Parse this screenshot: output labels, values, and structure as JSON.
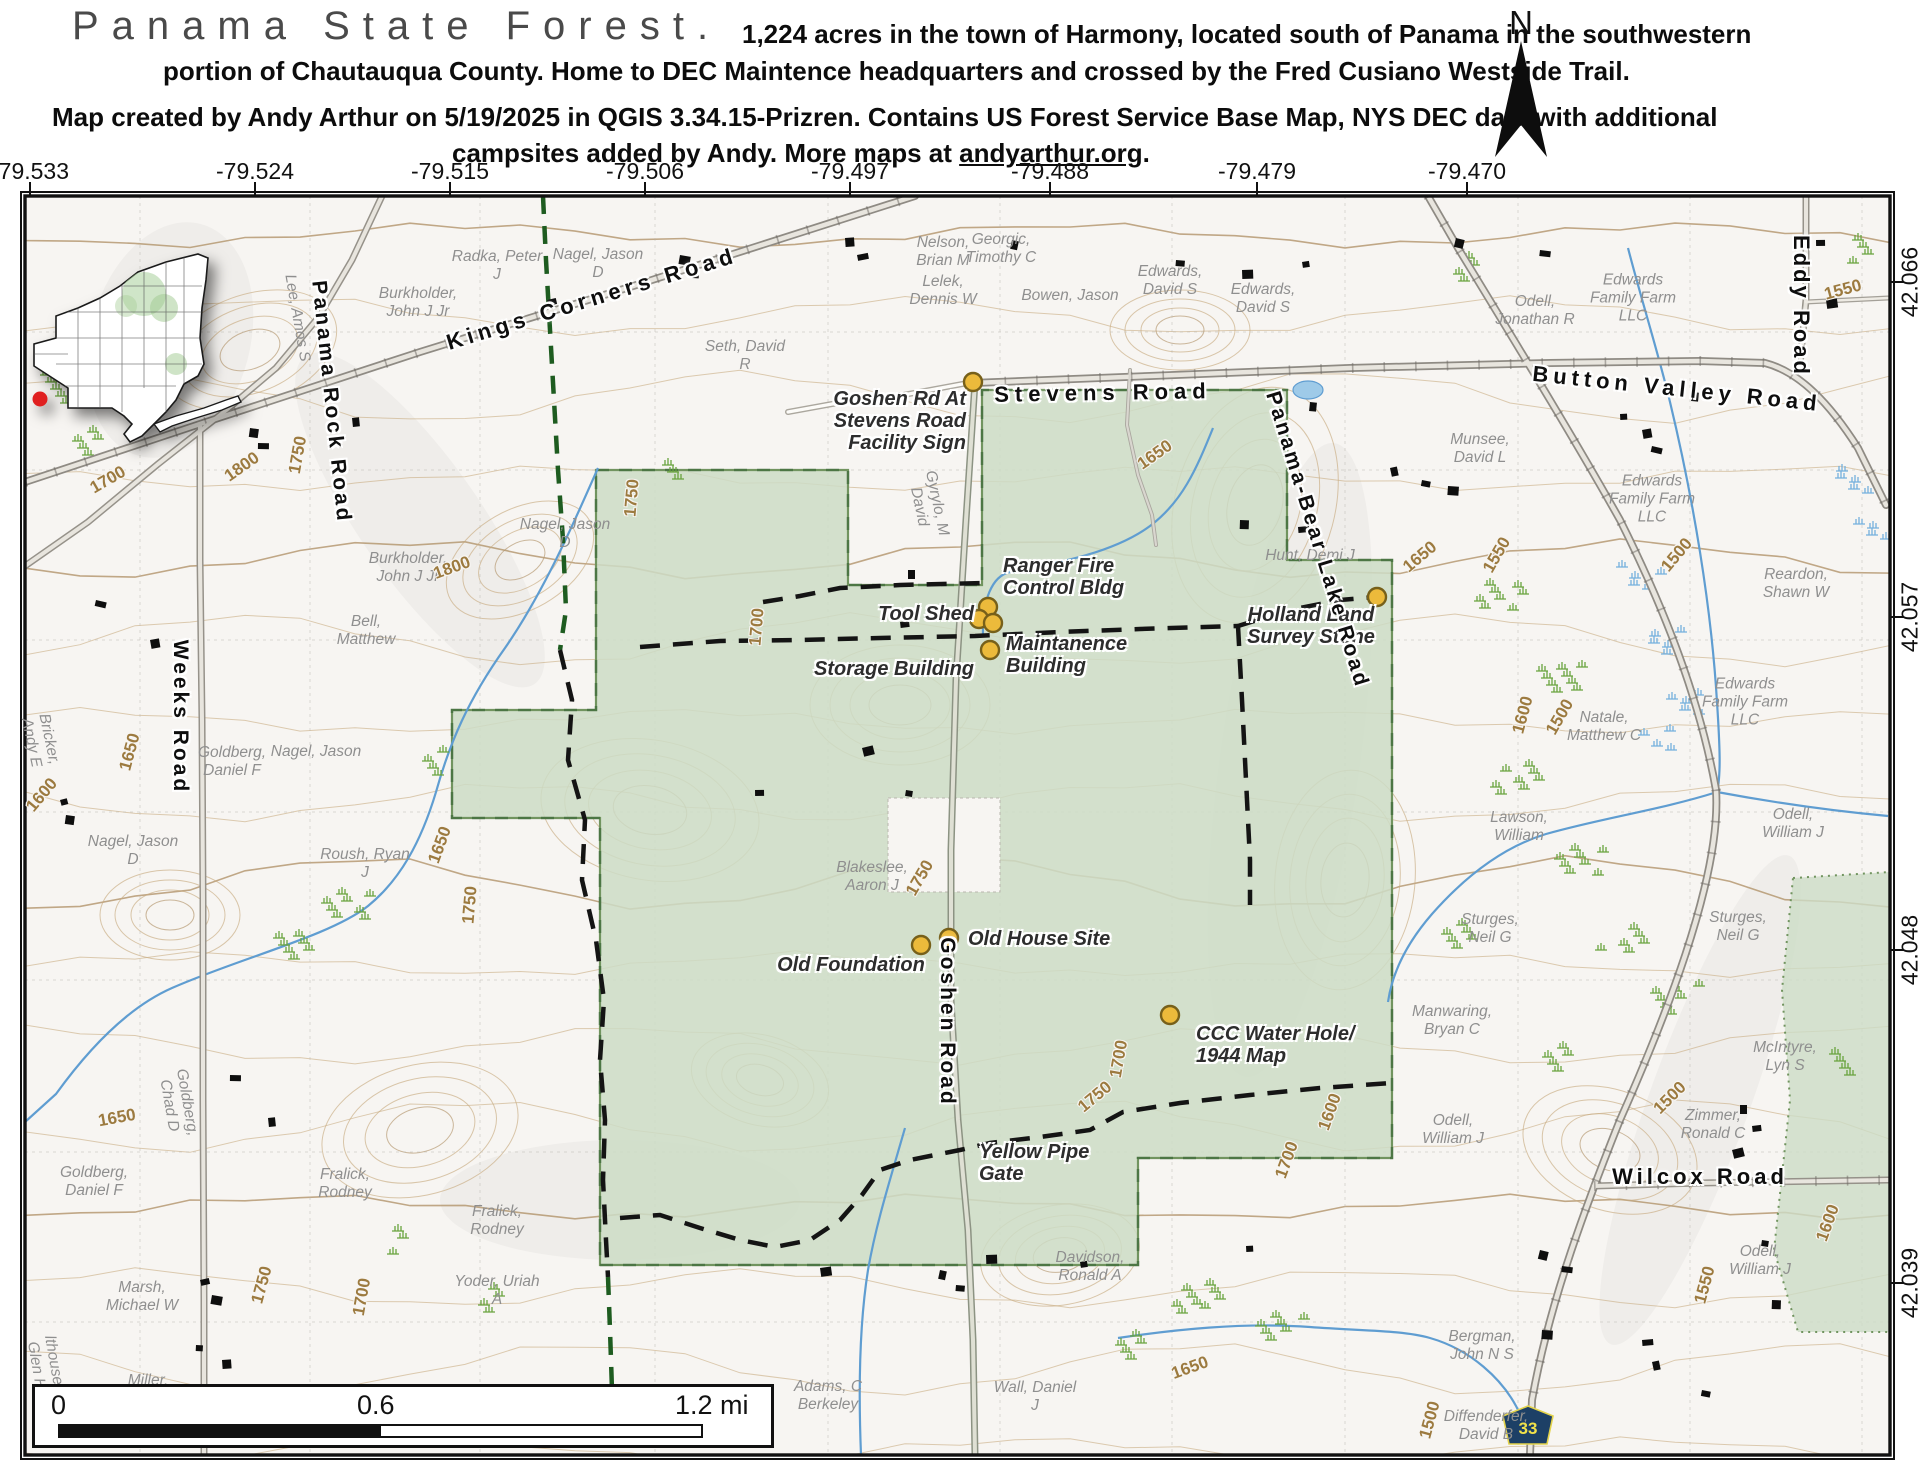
{
  "header": {
    "title": "Panama State Forest.",
    "subtitle_line1": "1,224 acres in the town of Harmony, located south of Panama in the southwestern",
    "subtitle_line2": "portion of Chautauqua County. Home to DEC Maintence headquarters and crossed by the Fred Cusiano Westside Trail.",
    "credit_line1": "Map created by Andy Arthur on 5/19/2025 in QGIS 3.34.15-Prizren. Contains US Forest Service Base Map, NYS DEC data with additional",
    "credit_line2_prefix": "campsites added by Andy. More maps at ",
    "credit_link": "andyarthur.org",
    "credit_line2_suffix": ".",
    "north_label": "N"
  },
  "axes": {
    "longitude": [
      {
        "label": "-79.533",
        "x": 30
      },
      {
        "label": "-79.524",
        "x": 255
      },
      {
        "label": "-79.515",
        "x": 450
      },
      {
        "label": "-79.506",
        "x": 645
      },
      {
        "label": "-79.497",
        "x": 850
      },
      {
        "label": "-79.488",
        "x": 1050
      },
      {
        "label": "-79.479",
        "x": 1257
      },
      {
        "label": "-79.470",
        "x": 1467
      }
    ],
    "latitude": [
      {
        "label": "42.066",
        "y": 282
      },
      {
        "label": "42.057",
        "y": 617
      },
      {
        "label": "42.048",
        "y": 950
      },
      {
        "label": "42.039",
        "y": 1283
      }
    ]
  },
  "scale_bar": {
    "start": "0",
    "middle": "0.6",
    "end": "1.2 mi"
  },
  "route_shield": {
    "number": "33"
  },
  "road_labels": [
    {
      "t": "Kings Corners Road",
      "x": 592,
      "y": 299,
      "r": -17,
      "ls": 5,
      "s": 22
    },
    {
      "t": "Stevens Road",
      "x": 1103,
      "y": 393,
      "r": -1,
      "ls": 6,
      "s": 22
    },
    {
      "t": "Button Valley Road",
      "x": 1677,
      "y": 389,
      "r": 6,
      "ls": 5,
      "s": 22
    },
    {
      "t": "Eddy Road",
      "x": 1801,
      "y": 306,
      "r": 90,
      "ls": 3,
      "s": 22
    },
    {
      "t": "Panama Rock Road",
      "x": 331,
      "y": 402,
      "r": 84,
      "ls": 3,
      "s": 21
    },
    {
      "t": "Weeks Road",
      "x": 180,
      "y": 717,
      "r": 90,
      "ls": 3,
      "s": 21
    },
    {
      "t": "Goshen Road",
      "x": 947,
      "y": 1022,
      "r": 90,
      "ls": 3,
      "s": 21
    },
    {
      "t": "Panama-Bear Lake Road",
      "x": 1317,
      "y": 540,
      "r": 73,
      "ls": 3,
      "s": 21
    },
    {
      "t": "Wilcox Road",
      "x": 1700,
      "y": 1177,
      "r": 0,
      "ls": 4,
      "s": 22
    }
  ],
  "poi_labels": [
    {
      "lines": "Goshen Rd At\nStevens Road\nFacility Sign",
      "x": 966,
      "y": 421,
      "align": "right"
    },
    {
      "lines": "Ranger Fire\nControl Bldg",
      "x": 1003,
      "y": 577,
      "align": "left"
    },
    {
      "lines": "Tool Shed",
      "x": 974,
      "y": 614,
      "align": "right"
    },
    {
      "lines": "Maintanence\nBuilding",
      "x": 1006,
      "y": 655,
      "align": "left"
    },
    {
      "lines": "Storage Building",
      "x": 974,
      "y": 669,
      "align": "right"
    },
    {
      "lines": "Holland Land\nSurvey Stone",
      "x": 1311,
      "y": 626,
      "align": "center"
    },
    {
      "lines": "Old Foundation",
      "x": 851,
      "y": 965,
      "align": "center"
    },
    {
      "lines": "Old House Site",
      "x": 968,
      "y": 939,
      "align": "left"
    },
    {
      "lines": "CCC Water Hole/\n1944 Map",
      "x": 1196,
      "y": 1045,
      "align": "left"
    },
    {
      "lines": "Yellow Pipe\nGate",
      "x": 979,
      "y": 1163,
      "align": "left"
    }
  ],
  "owner_labels": [
    {
      "t": "Radka, Peter\nJ",
      "x": 497,
      "y": 266
    },
    {
      "t": "Burkholder,\nJohn J Jr",
      "x": 418,
      "y": 303
    },
    {
      "t": "Nagel, Jason\nD",
      "x": 598,
      "y": 264
    },
    {
      "t": "Nelson,\nBrian M",
      "x": 943,
      "y": 252
    },
    {
      "t": "Georgic,\nTimothy C",
      "x": 1001,
      "y": 249
    },
    {
      "t": "Lelek,\nDennis W",
      "x": 943,
      "y": 291
    },
    {
      "t": "Bowen, Jason",
      "x": 1070,
      "y": 296
    },
    {
      "t": "Edwards,\nDavid S",
      "x": 1170,
      "y": 281
    },
    {
      "t": "Edwards,\nDavid S",
      "x": 1263,
      "y": 299
    },
    {
      "t": "Odell,\nJonathan R",
      "x": 1535,
      "y": 311
    },
    {
      "t": "Edwards\nFamily Farm\nLLC",
      "x": 1633,
      "y": 298
    },
    {
      "t": "Lee, Amos S",
      "x": 297,
      "y": 318,
      "r": 80
    },
    {
      "t": "Seth, David\nR",
      "x": 745,
      "y": 356
    },
    {
      "t": "Burkholder,\nJohn J Jr",
      "x": 408,
      "y": 568
    },
    {
      "t": "Bell,\nMatthew",
      "x": 366,
      "y": 631
    },
    {
      "t": "Nagel, Jason\nD",
      "x": 565,
      "y": 534
    },
    {
      "t": "Goldberg,\nDaniel F",
      "x": 232,
      "y": 762
    },
    {
      "t": "Nagel, Jason",
      "x": 316,
      "y": 752
    },
    {
      "t": "Roush, Ryan\nJ",
      "x": 365,
      "y": 864
    },
    {
      "t": "Bricker,\nAndy E",
      "x": 40,
      "y": 741,
      "r": 78
    },
    {
      "t": "Nagel, Jason\nD",
      "x": 133,
      "y": 851
    },
    {
      "t": "Gyrylo, M\nDavid",
      "x": 928,
      "y": 505,
      "r": 78
    },
    {
      "t": "Blakeslee,\nAaron J",
      "x": 872,
      "y": 877
    },
    {
      "t": "Goldberg,\nChad D",
      "x": 178,
      "y": 1104,
      "r": 80
    },
    {
      "t": "Goldberg,\nDaniel F",
      "x": 94,
      "y": 1182
    },
    {
      "t": "Fralick,\nRodney",
      "x": 345,
      "y": 1184
    },
    {
      "t": "Fralick,\nRodney",
      "x": 497,
      "y": 1221
    },
    {
      "t": "Marsh,\nMichael W",
      "x": 142,
      "y": 1297
    },
    {
      "t": "Yoder, Uriah\nA",
      "x": 497,
      "y": 1291
    },
    {
      "t": "Miller,",
      "x": 148,
      "y": 1381
    },
    {
      "t": "lthouse,\nGlen H",
      "x": 45,
      "y": 1364,
      "r": 80
    },
    {
      "t": "Adams, C\nBerkeley",
      "x": 828,
      "y": 1396
    },
    {
      "t": "Wall, Daniel\nJ",
      "x": 1035,
      "y": 1397
    },
    {
      "t": "Davidson,\nRonald A",
      "x": 1090,
      "y": 1267
    },
    {
      "t": "Hunt, Demi J",
      "x": 1310,
      "y": 556
    },
    {
      "t": "Munsee,\nDavid L",
      "x": 1480,
      "y": 449
    },
    {
      "t": "Reardon,\nShawn W",
      "x": 1796,
      "y": 584
    },
    {
      "t": "Edwards\nFamily Farm\nLLC",
      "x": 1652,
      "y": 499
    },
    {
      "t": "Edwards\nFamily Farm\nLLC",
      "x": 1745,
      "y": 702
    },
    {
      "t": "Natale,\nMatthew C",
      "x": 1604,
      "y": 727
    },
    {
      "t": "Lawson,\nWilliam",
      "x": 1519,
      "y": 827
    },
    {
      "t": "Odell,\nWilliam J",
      "x": 1793,
      "y": 824
    },
    {
      "t": "Sturges,\nNeil G",
      "x": 1490,
      "y": 929
    },
    {
      "t": "Sturges,\nNeil G",
      "x": 1738,
      "y": 927
    },
    {
      "t": "Manwaring,\nBryan C",
      "x": 1452,
      "y": 1021
    },
    {
      "t": "Odell,\nWilliam J",
      "x": 1453,
      "y": 1130
    },
    {
      "t": "McIntyre,\nLyn S",
      "x": 1785,
      "y": 1057
    },
    {
      "t": "Zimmer,\nRonald C",
      "x": 1713,
      "y": 1125
    },
    {
      "t": "Odell,\nWilliam J",
      "x": 1760,
      "y": 1261
    },
    {
      "t": "Bergman,\nJohn N S",
      "x": 1482,
      "y": 1346
    },
    {
      "t": "Diffenderfer,\nDavid B",
      "x": 1486,
      "y": 1426
    }
  ],
  "contour_labels": [
    {
      "t": "1800",
      "x": 242,
      "y": 467,
      "r": -35
    },
    {
      "t": "1800",
      "x": 452,
      "y": 568,
      "r": -20
    },
    {
      "t": "1750",
      "x": 298,
      "y": 455,
      "r": -80
    },
    {
      "t": "1750",
      "x": 632,
      "y": 498,
      "r": -85
    },
    {
      "t": "1750",
      "x": 470,
      "y": 905,
      "r": -85
    },
    {
      "t": "1750",
      "x": 920,
      "y": 878,
      "r": -60
    },
    {
      "t": "1750",
      "x": 262,
      "y": 1285,
      "r": -75
    },
    {
      "t": "1750",
      "x": 1095,
      "y": 1097,
      "r": -40
    },
    {
      "t": "1700",
      "x": 108,
      "y": 480,
      "r": -30
    },
    {
      "t": "1700",
      "x": 757,
      "y": 627,
      "r": -85
    },
    {
      "t": "1700",
      "x": 1119,
      "y": 1059,
      "r": -80
    },
    {
      "t": "1700",
      "x": 1287,
      "y": 1160,
      "r": -70
    },
    {
      "t": "1700",
      "x": 362,
      "y": 1297,
      "r": -80
    },
    {
      "t": "1650",
      "x": 130,
      "y": 752,
      "r": -75
    },
    {
      "t": "1650",
      "x": 440,
      "y": 845,
      "r": -70
    },
    {
      "t": "1650",
      "x": 117,
      "y": 1118,
      "r": -10
    },
    {
      "t": "1650",
      "x": 1155,
      "y": 455,
      "r": -35
    },
    {
      "t": "1650",
      "x": 1420,
      "y": 557,
      "r": -40
    },
    {
      "t": "1650",
      "x": 1190,
      "y": 1368,
      "r": -20
    },
    {
      "t": "1600",
      "x": 42,
      "y": 795,
      "r": -50
    },
    {
      "t": "1600",
      "x": 1523,
      "y": 715,
      "r": -75
    },
    {
      "t": "1600",
      "x": 1330,
      "y": 1112,
      "r": -70
    },
    {
      "t": "1600",
      "x": 1828,
      "y": 1223,
      "r": -70
    },
    {
      "t": "1550",
      "x": 1497,
      "y": 555,
      "r": -60
    },
    {
      "t": "1550",
      "x": 1705,
      "y": 1285,
      "r": -75
    },
    {
      "t": "1550",
      "x": 1843,
      "y": 290,
      "r": -15
    },
    {
      "t": "1500",
      "x": 1560,
      "y": 717,
      "r": -60
    },
    {
      "t": "1500",
      "x": 1677,
      "y": 555,
      "r": -50
    },
    {
      "t": "1500",
      "x": 1670,
      "y": 1098,
      "r": -45
    },
    {
      "t": "1500",
      "x": 1430,
      "y": 1420,
      "r": -75
    }
  ],
  "markers": {
    "poi_dots": [
      [
        973,
        382
      ],
      [
        988,
        607
      ],
      [
        979,
        619
      ],
      [
        993,
        623
      ],
      [
        990,
        650
      ],
      [
        1377,
        597
      ],
      [
        921,
        945
      ],
      [
        949,
        938
      ],
      [
        1170,
        1015
      ]
    ],
    "inset_location_dot_color": "#e02020"
  },
  "colors": {
    "forest_fill": "#ccdcc6",
    "forest_stroke": "#71945f",
    "forest_dash": "#2e5c2e",
    "contour": "#c8ab80",
    "contour_index": "#b2946a",
    "stream": "#5f9dd1",
    "trail_black": "#141414",
    "trail_green": "#1e5c20",
    "poi_dot_fill": "#ecba3b",
    "poi_dot_stroke": "#77601a",
    "shield_fill": "#1d4066",
    "shield_text": "#f2e24a",
    "map_bg": "#f7f5f2"
  }
}
